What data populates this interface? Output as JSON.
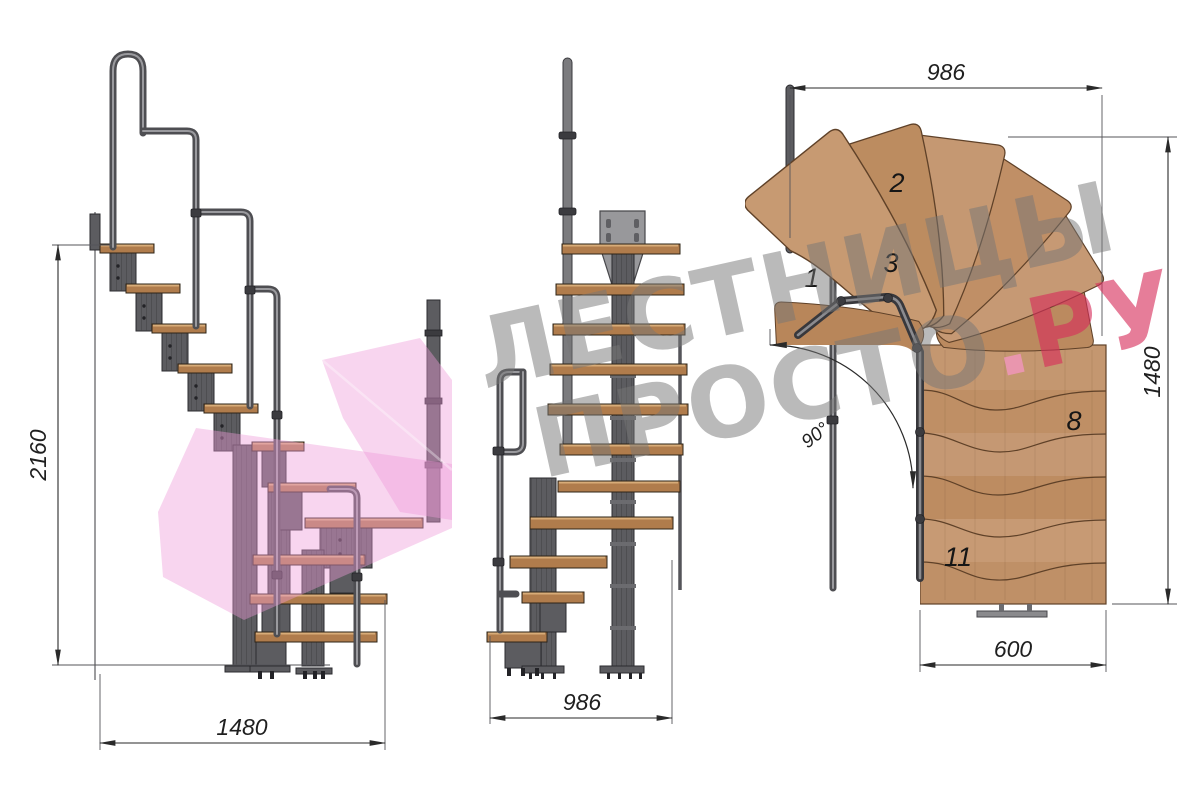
{
  "watermark": {
    "line1": "ЛЕСТНИЦЫ",
    "line2": "ПРОСТО",
    "dot": ".",
    "tld": "РУ"
  },
  "side_view": {
    "height_dim": "2160",
    "width_dim": "1480"
  },
  "front_view": {
    "width_dim": "986"
  },
  "plan_view": {
    "top_dim": "986",
    "right_dim": "1480",
    "bottom_dim": "600",
    "angle": "90°",
    "labels": [
      "1",
      "2",
      "3",
      "8",
      "11"
    ]
  },
  "colors": {
    "wood": "#c1936b",
    "metal": "#5c5c60",
    "rail": "#4e4e52",
    "dim_line": "#2a2a2a",
    "pink_watermark": "#ef9ad9",
    "watermark_gray": "#787878",
    "watermark_red": "#d62d5a"
  }
}
